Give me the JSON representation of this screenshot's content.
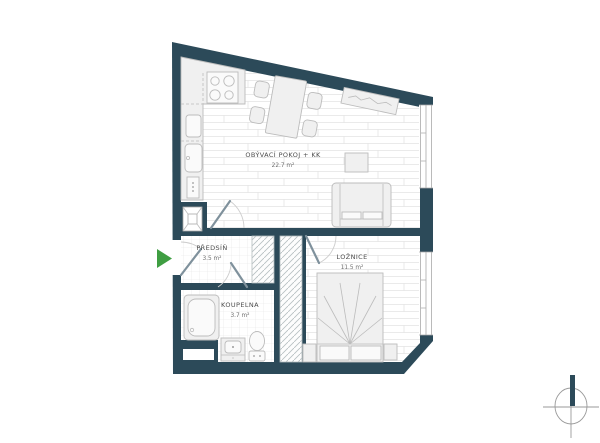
{
  "title": "apartment-floor-plan",
  "rooms": {
    "living": {
      "name": "OBÝVACÍ POKOJ + KK",
      "area": "22.7 m²"
    },
    "bedroom": {
      "name": "LOŽNICE",
      "area": "11.5 m²"
    },
    "hall": {
      "name": "PŘEDSÍŇ",
      "area": "3.5 m²"
    },
    "bathroom": {
      "name": "KOUPELNA",
      "area": "3.7 m²"
    }
  },
  "colors": {
    "wall": "#2c4a59",
    "entrance_green": "#3f9e42",
    "label": "#4d4d4d",
    "furn_fill": "#f0f0f0",
    "furn_stroke": "#bcbcbc",
    "compass": "#9a9a9a",
    "hatch": "#b9c1c3"
  },
  "icons": {
    "entrance": "entrance-arrow",
    "north": "north-compass"
  }
}
